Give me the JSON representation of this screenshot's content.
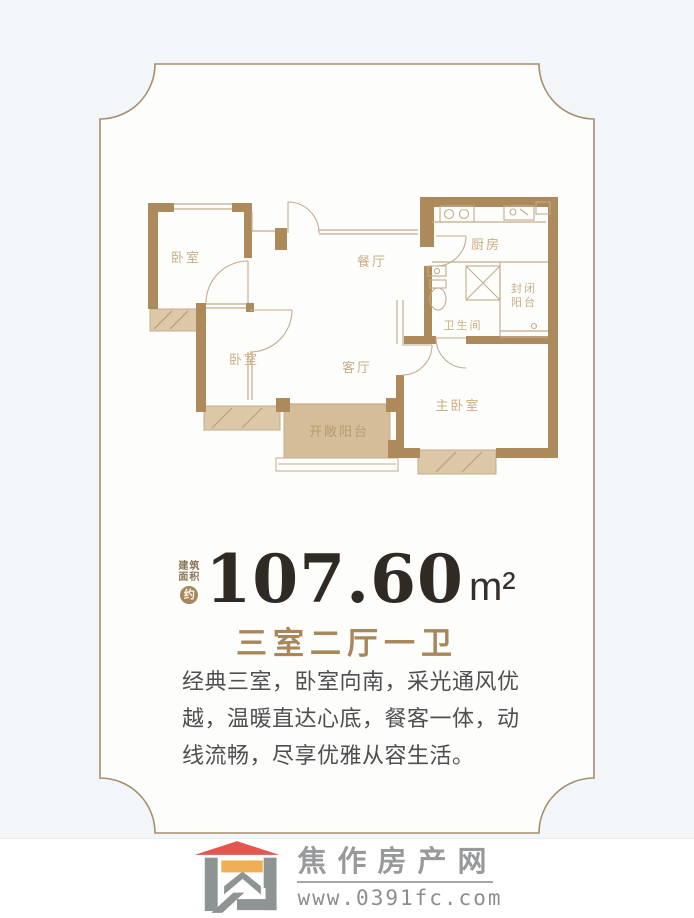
{
  "colors": {
    "page_bg": "#f3f6f9",
    "card_bg": "#fdfdfc",
    "frame_line": "#a68e6c",
    "wall": "#ad8a5c",
    "balcony_fill": "#d5bd99",
    "plan_label": "#c9ae83",
    "accent_brown": "#a8875a",
    "number_color": "#2f2a24",
    "logo_roof": "#e25850",
    "logo_accent": "#f0ae57",
    "logo_gray": "#8e9394"
  },
  "floorplan": {
    "rooms": [
      {
        "id": "bedroom-1",
        "label": "卧室"
      },
      {
        "id": "bedroom-2",
        "label": "卧室"
      },
      {
        "id": "dining-room",
        "label": "餐厅"
      },
      {
        "id": "living-room",
        "label": "客厅"
      },
      {
        "id": "kitchen",
        "label": "厨房"
      },
      {
        "id": "bathroom",
        "label": "卫生间"
      },
      {
        "id": "master-bedroom",
        "label": "主卧室"
      },
      {
        "id": "open-balcony",
        "label": "开敞阳台"
      }
    ],
    "closed_balcony_lines": [
      "封闭",
      "阳台"
    ]
  },
  "area": {
    "prefix_line1": "建筑",
    "prefix_line2": "面积",
    "approx": "约",
    "value": "107.60",
    "unit": "m²"
  },
  "layout_title": "三室二厅一卫",
  "description": "经典三室，卧室向南，采光通风优\n越，温暖直达心底，餐客一体，动\n线流畅，尽享优雅从容生活。",
  "footer": {
    "site_name": "焦作房产网",
    "url": "www.0391fc.com"
  }
}
